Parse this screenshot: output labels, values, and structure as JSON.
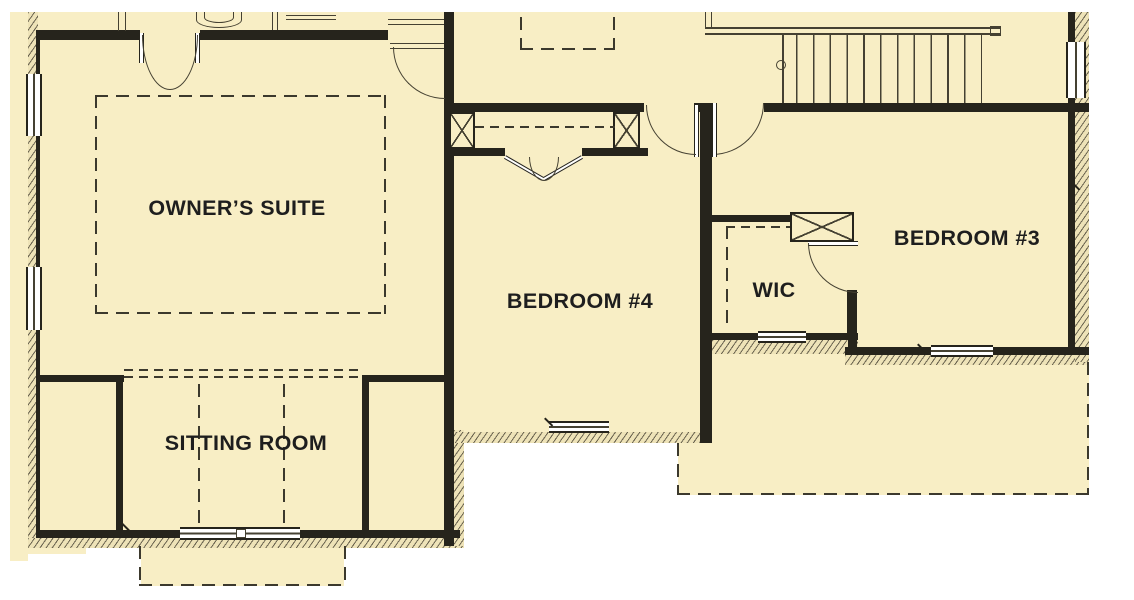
{
  "rooms": [
    {
      "name": "owners-suite",
      "label": "OWNER’S SUITE"
    },
    {
      "name": "bedroom-4",
      "label": "BEDROOM #4"
    },
    {
      "name": "wic",
      "label": "WIC"
    },
    {
      "name": "bedroom-3",
      "label": "BEDROOM #3"
    },
    {
      "name": "sitting-room",
      "label": "SITTING ROOM"
    }
  ],
  "stairs": {
    "treads": 12
  },
  "colors": {
    "paper": "#f8eec5",
    "ink": "#26241c",
    "line": "#454132",
    "dash": "#3c392d",
    "hatchbg": "#eee3b8",
    "hatchln": "#6b6450",
    "text": "#1e1e1e",
    "bg": "#ffffff"
  }
}
